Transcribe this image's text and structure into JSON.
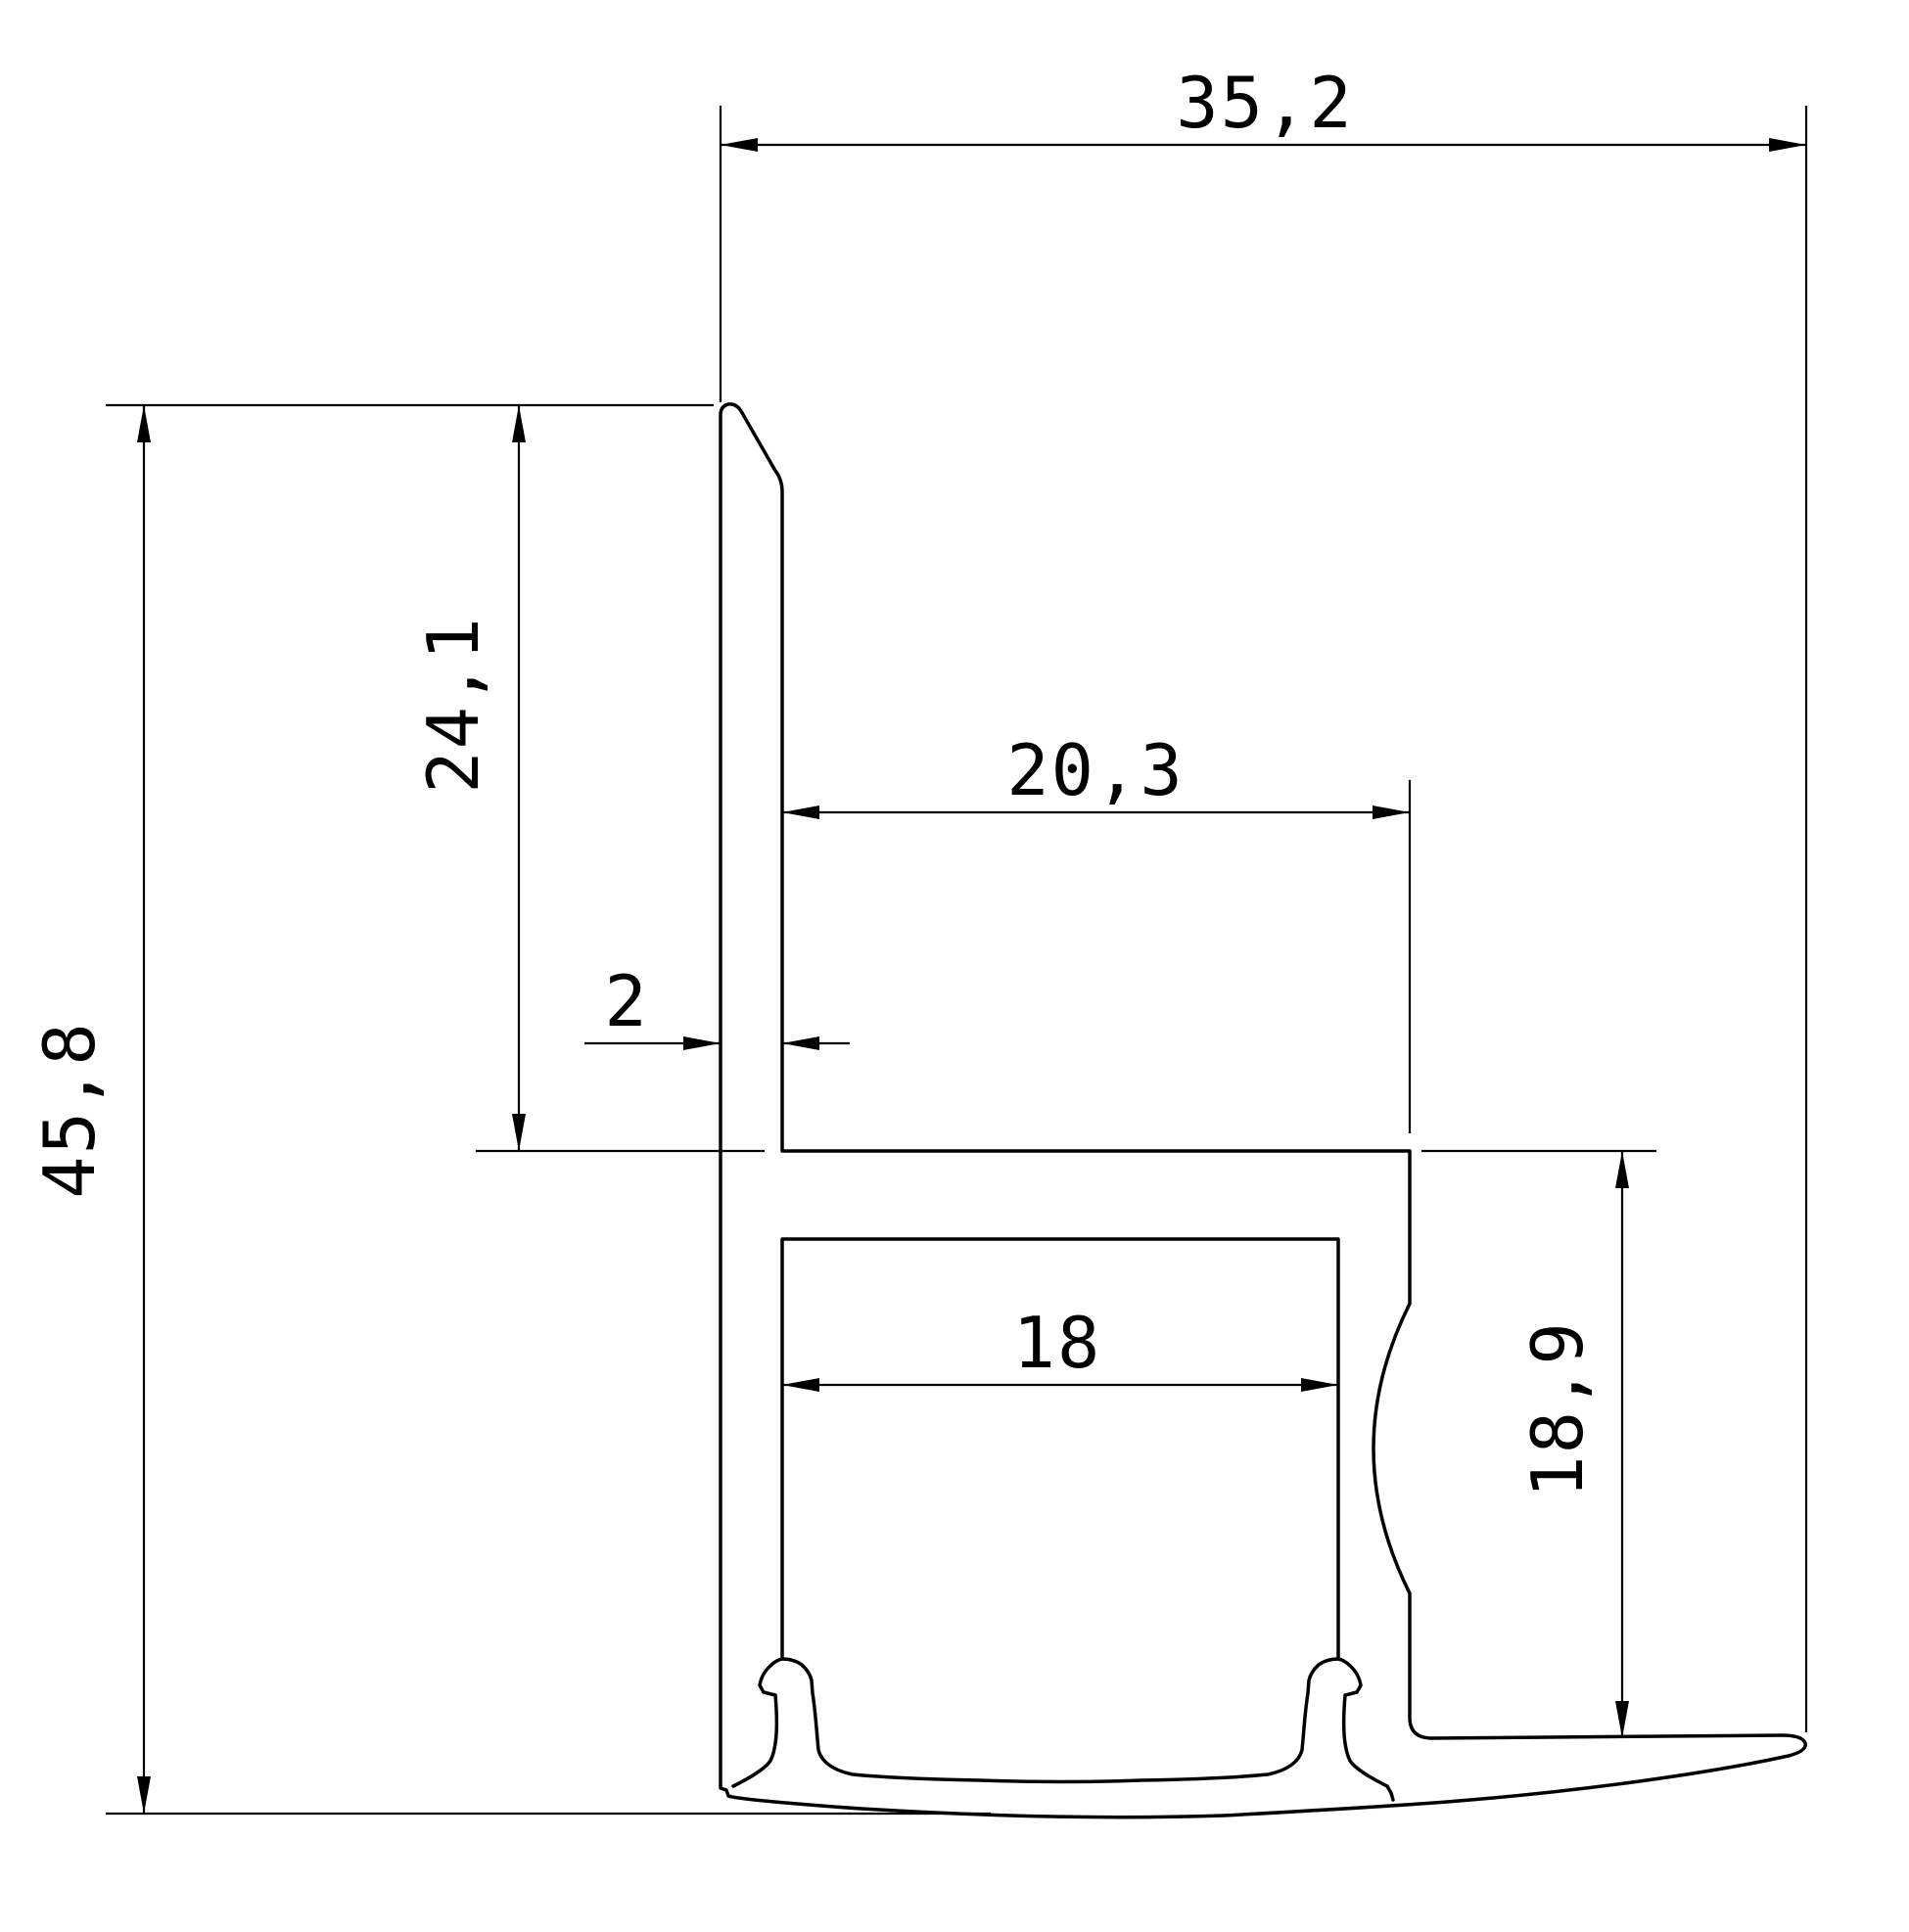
{
  "drawing": {
    "type": "technical-profile-cross-section",
    "colors": {
      "background": "#ffffff",
      "line": "#000000"
    },
    "dimensions": {
      "total_width": "35,2",
      "total_height": "45,8",
      "upper_wall_height": "24,1",
      "upper_channel_width": "20,3",
      "wall_thickness": "2",
      "led_channel_width": "18",
      "lower_right_height": "18,9"
    }
  }
}
